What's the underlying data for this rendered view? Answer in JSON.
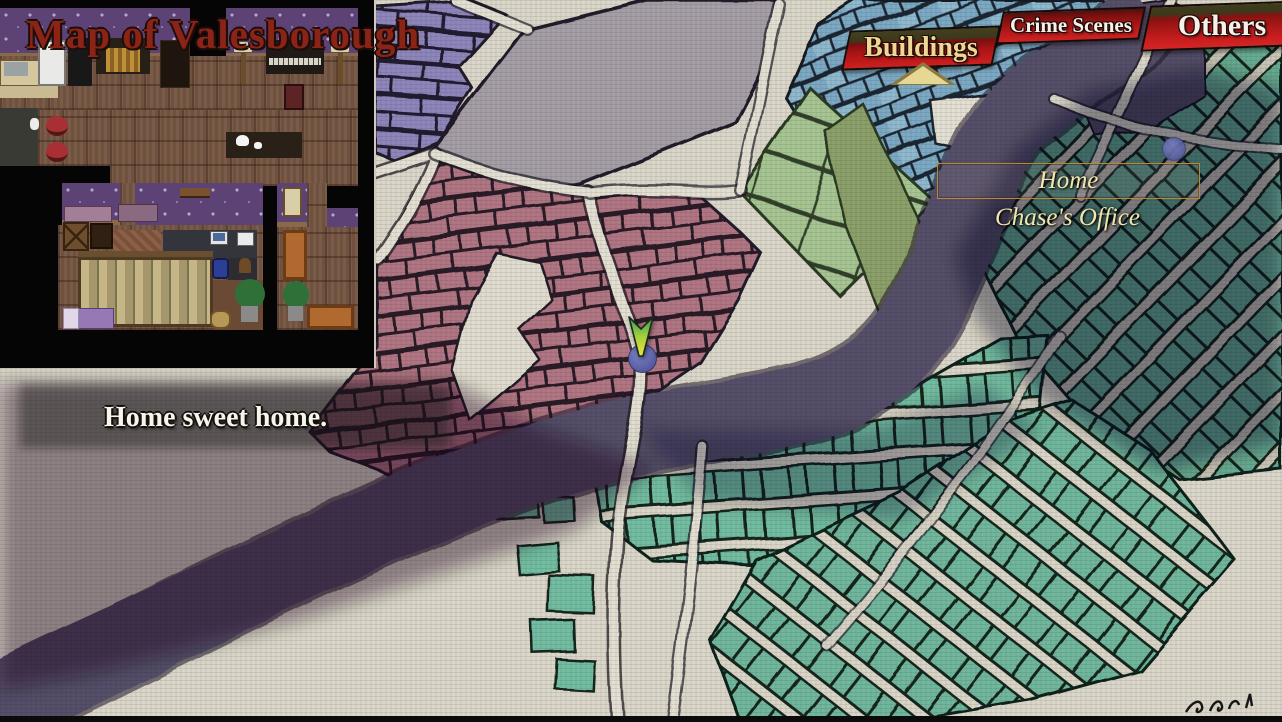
{
  "title": "Map of Valesborough",
  "tabs": {
    "buildings": {
      "label": "Buildings",
      "selected": true
    },
    "crime_scenes": {
      "label": "Crime Scenes",
      "selected": false
    },
    "others": {
      "label": "Others",
      "selected": false
    }
  },
  "map_labels": {
    "home": "Home",
    "chase_office": "Chase's Office"
  },
  "caption": "Home sweet home.",
  "markers": {
    "player_pin": "arrow-pin",
    "home_location": "dot"
  },
  "colors": {
    "paper": "#dad6c9",
    "banner_red": "#c41d1d",
    "banner_olive": "#3c381c",
    "selected_tab_text": "#ecd793",
    "tab_text": "#f5f0e8",
    "title_red": "#8b2317",
    "label_cream": "#f2e6b0",
    "label_box_border": "#b8873a",
    "district_pink": "#b17684",
    "district_blue": "#7ba9c3",
    "district_teal": "#73bda2",
    "district_purple": "#8e86bb",
    "district_green": "#a7c593",
    "plaza_gray": "#a59ea6",
    "river": "#56506a",
    "marker_blue": "#565d9e"
  }
}
